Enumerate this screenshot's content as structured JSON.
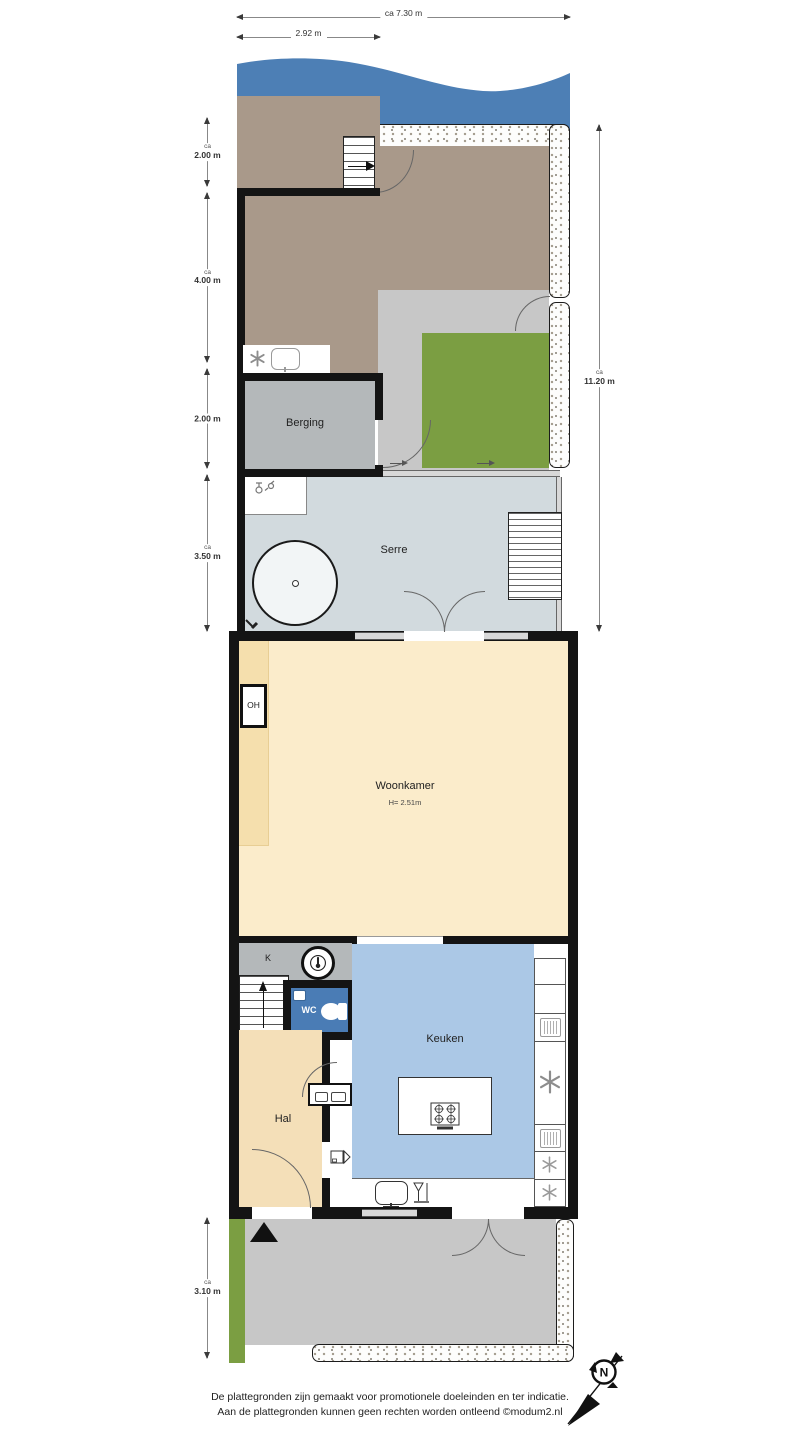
{
  "title": "Begane grond plattegrond",
  "dimensions": {
    "top": [
      {
        "label": "ca 7.30 m"
      },
      {
        "label": "2.92 m"
      }
    ],
    "left": [
      {
        "prefix": "ca",
        "value": "2.00 m"
      },
      {
        "prefix": "ca",
        "value": "4.00 m"
      },
      {
        "prefix": "",
        "value": "2.00 m"
      },
      {
        "prefix": "ca",
        "value": "3.50 m"
      },
      {
        "prefix": "ca",
        "value": "3.10 m"
      }
    ],
    "right": [
      {
        "prefix": "ca",
        "value": "11.20 m"
      }
    ]
  },
  "rooms": {
    "berging": "Berging",
    "serre": "Serre",
    "woonkamer": "Woonkamer",
    "woonkamer_height": "H= 2.51m",
    "closet": "K",
    "wc": "WC",
    "keuken": "Keuken",
    "hal": "Hal",
    "fireplace": "OH"
  },
  "compass": {
    "north_label": "N"
  },
  "footer": {
    "line1": "De plattegronden zijn gemaakt voor promotionele doeleinden en ter indicatie.",
    "line2": "Aan de plattegronden kunnen geen rechten worden ontleend ©modum2.nl"
  },
  "colors": {
    "water": "#4d7fb5",
    "terrace": "#a9998a",
    "path": "#c7c7c7",
    "grass": "#7b9e42",
    "berging": "#b4b8ba",
    "serre": "#d2dade",
    "woonkamer": "#fbeccb",
    "woonkamer_step": "#f5dfad",
    "hal": "#f4dfb8",
    "keuken": "#abc8e6",
    "wc": "#4a7cb5",
    "wall": "#141414"
  },
  "icons": [
    "stairs",
    "boiler-thermometer",
    "toilet",
    "washbasin",
    "kitchen-sink",
    "gas-hob",
    "oven",
    "snowflake",
    "washing-machine",
    "outdoor-sink",
    "radiator",
    "round-table",
    "compass-north",
    "entrance-arrow"
  ]
}
